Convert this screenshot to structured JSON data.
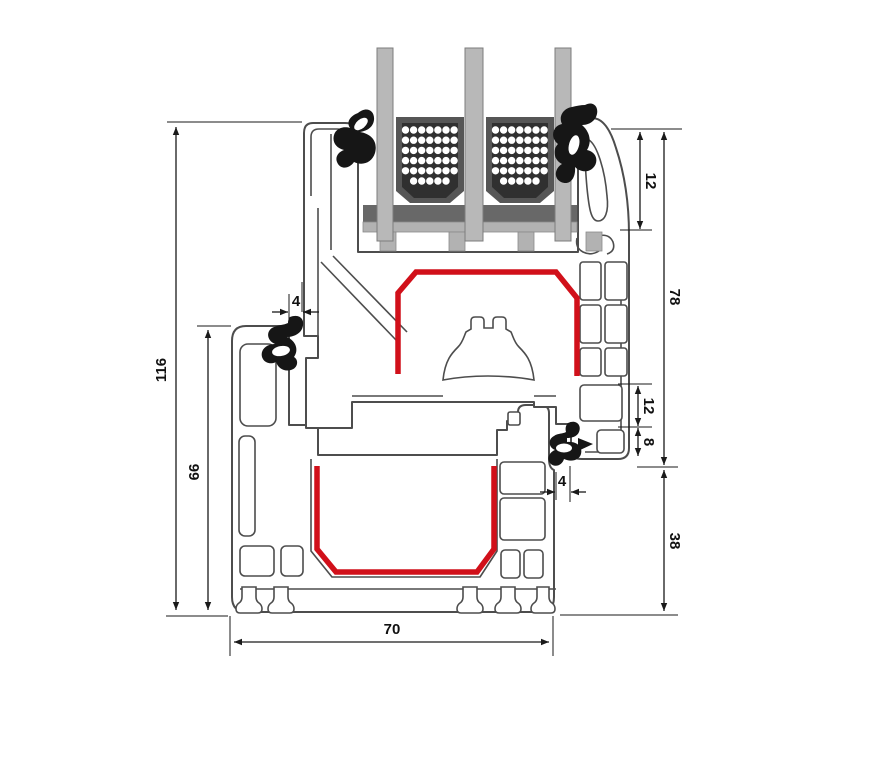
{
  "diagram": {
    "type": "technical-cross-section",
    "subject": "PVC window frame and sash profile section with triple insulated glazing",
    "units": "mm",
    "colors": {
      "outline": "#4d4d4d",
      "reinforcement_red": "#d1101a",
      "glass_gray": "#b8b8b8",
      "gasket_black": "#161616",
      "spacer_body": "#565656",
      "spacer_core": "#303030",
      "setting_block": "#686868",
      "dimension": "#1a1a1a",
      "background": "#ffffff"
    },
    "dimensions": {
      "total_height": "116",
      "frame_height": "66",
      "top_gap": "4",
      "glazing_cover": "12",
      "sash_height": "78",
      "step_12": "12",
      "step_8": "8",
      "bottom_gap": "4",
      "frame_face": "38",
      "depth": "70"
    },
    "components": {
      "glass_pane_count": 3,
      "spacer_bar_count": 2,
      "gasket_count": 4,
      "reinforcement_outline_count": 2
    }
  }
}
